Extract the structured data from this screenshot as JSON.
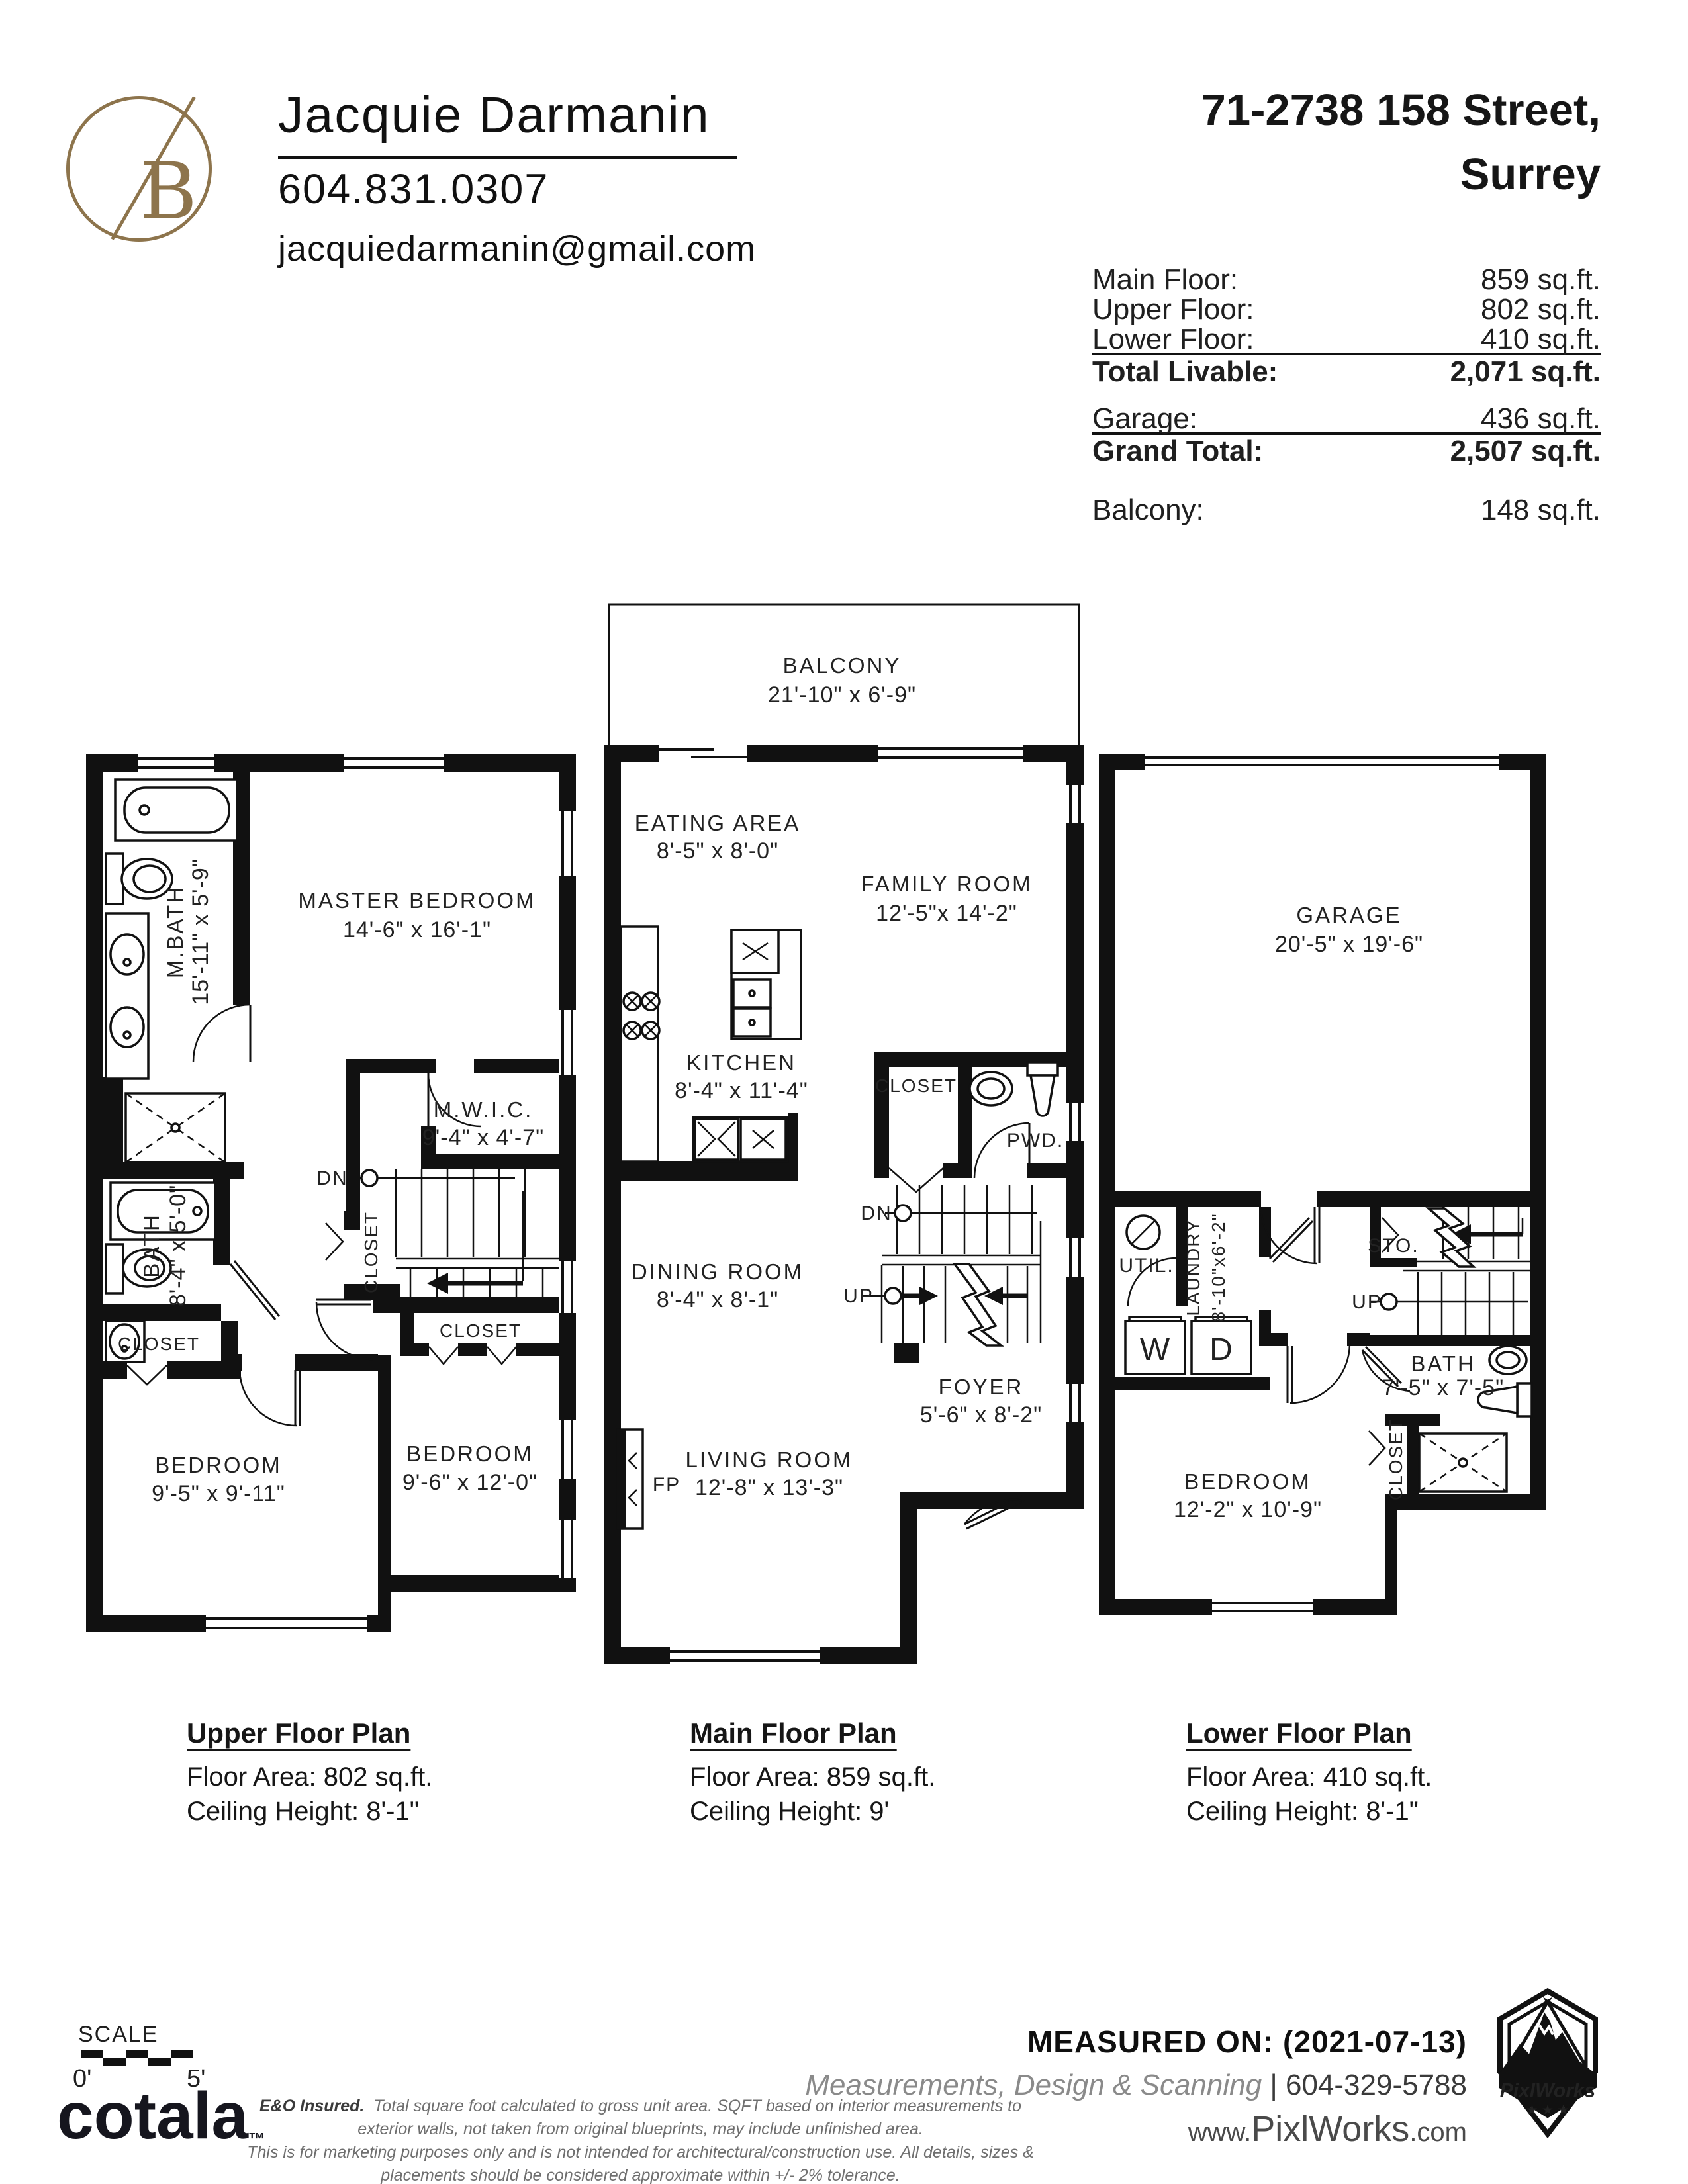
{
  "colors": {
    "gold": "#8d744c",
    "ink": "#1f1f1f",
    "gray": "#6f6f6f"
  },
  "header": {
    "logo_letter": "B",
    "agent_name": "Jacquie Darmanin",
    "agent_phone": "604.831.0307",
    "agent_email": "jacquiedarmanin@gmail.com",
    "address_line1": "71-2738 158 Street,",
    "address_line2": "Surrey"
  },
  "areas": {
    "main_floor_label": "Main Floor:",
    "main_floor_value": "859 sq.ft.",
    "upper_floor_label": "Upper Floor:",
    "upper_floor_value": "802 sq.ft.",
    "lower_floor_label": "Lower Floor:",
    "lower_floor_value": "410 sq.ft.",
    "total_livable_label": "Total Livable:",
    "total_livable_value": "2,071 sq.ft.",
    "garage_label": "Garage:",
    "garage_value": "436 sq.ft.",
    "grand_total_label": "Grand Total:",
    "grand_total_value": "2,507 sq.ft.",
    "balcony_label": "Balcony:",
    "balcony_value": "148 sq.ft."
  },
  "plans": {
    "upper": {
      "caption_title": "Upper Floor Plan",
      "caption_area": "Floor Area: 802 sq.ft.",
      "caption_ceiling": "Ceiling Height: 8'-1\"",
      "rooms": {
        "mbath_name": "M.BATH",
        "mbath_dims": "15'-11\" x 5'-9\"",
        "master_name": "MASTER BEDROOM",
        "master_dims": "14'-6\" x 16'-1\"",
        "mwic_name": "M.W.I.C.",
        "mwic_dims": "9'-4\" x 4'-7\"",
        "bath_name": "BATH",
        "bath_dims": "8'-4\" x 5'-0\"",
        "closet_left": "CLOSET",
        "closet_mid": "CLOSET",
        "closet_right": "CLOSET",
        "bedroom1_name": "BEDROOM",
        "bedroom1_dims": "9'-5\" x 9'-11\"",
        "bedroom2_name": "BEDROOM",
        "bedroom2_dims": "9'-6\" x 12'-0\"",
        "dn": "DN"
      }
    },
    "main": {
      "caption_title": "Main Floor Plan",
      "caption_area": "Floor Area: 859 sq.ft.",
      "caption_ceiling": "Ceiling Height: 9'",
      "rooms": {
        "balcony_name": "BALCONY",
        "balcony_dims": "21'-10\" x 6'-9\"",
        "eating_name": "EATING AREA",
        "eating_dims": "8'-5\" x 8'-0\"",
        "family_name": "FAMILY ROOM",
        "family_dims": "12'-5\"x 14'-2\"",
        "kitchen_name": "KITCHEN",
        "kitchen_dims": "8'-4\" x 11'-4\"",
        "closet": "CLOSET",
        "pwd": "PWD.",
        "dining_name": "DINING ROOM",
        "dining_dims": "8'-4\" x 8'-1\"",
        "foyer_name": "FOYER",
        "foyer_dims": "5'-6\" x 8'-2\"",
        "living_name": "LIVING ROOM",
        "living_dims": "12'-8\" x 13'-3\"",
        "fp": "FP",
        "dn": "DN",
        "up": "UP"
      }
    },
    "lower": {
      "caption_title": "Lower Floor Plan",
      "caption_area": "Floor Area: 410 sq.ft.",
      "caption_ceiling": "Ceiling Height: 8'-1\"",
      "rooms": {
        "garage_name": "GARAGE",
        "garage_dims": "20'-5\" x 19'-6\"",
        "util": "UTIL.",
        "laundry_name": "LAUNDRY",
        "laundry_dims": "8'-10\"x6'-2\"",
        "w": "W",
        "d": "D",
        "sto": "STO.",
        "up": "UP",
        "bath_name": "BATH",
        "bath_dims": "7'-5\" x 7'-5\"",
        "closet": "CLOSET",
        "bedroom_name": "BEDROOM",
        "bedroom_dims": "12'-2\" x 10'-9\""
      }
    }
  },
  "footer": {
    "scale_label": "SCALE",
    "scale_left": "0'",
    "scale_right": "5'",
    "cotala": "cotala",
    "cotala_tm": "™",
    "disclaimer_bold": "E&O Insured.",
    "disclaimer_line1": "Total square foot calculated to gross unit area. SQFT based on interior measurements to exterior walls, not taken from original blueprints, may include unfinished area.",
    "disclaimer_line2": "This is for marketing purposes only and is not intended for architectural/construction use.  All details, sizes & placements should be considered approximate within +/- 2%  tolerance.",
    "measured_on": "MEASURED ON: (2021-07-13)",
    "services": "Measurements, Design & Scanning",
    "services_sep": "| ",
    "services_phone": "604-329-5788",
    "website_www": "www.",
    "website_name": "PixlWorks",
    "website_tld": ".com",
    "badge_name": "PixlWorks"
  }
}
